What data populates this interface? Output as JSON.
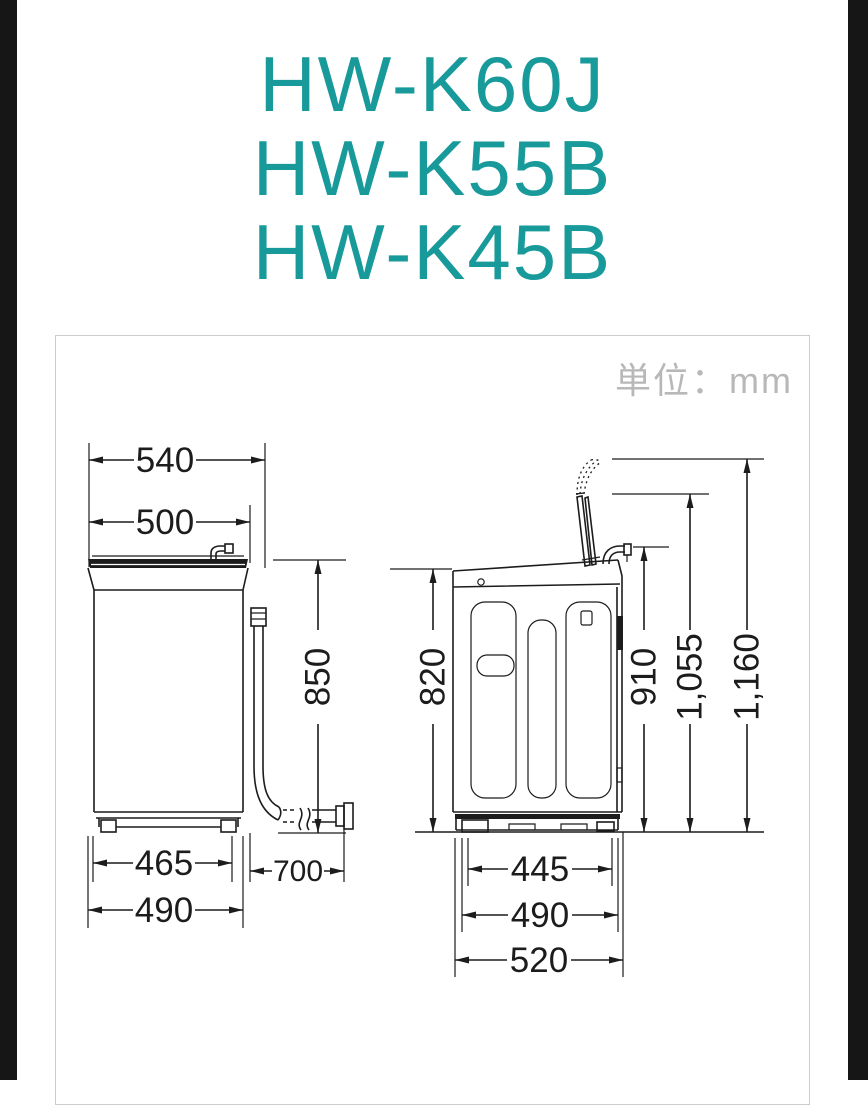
{
  "colors": {
    "accent_teal": "#189a9b",
    "drawing_line": "#1c1c1c",
    "unit_text_gray": "#b8b8b8",
    "bezel_black": "#161616",
    "panel_border": "#cccccc"
  },
  "title": {
    "models": [
      "HW-K60J",
      "HW-K55B",
      "HW-K45B"
    ]
  },
  "diagram": {
    "unit_label": "単位：mm",
    "front_view": {
      "dimensions": {
        "overall_width_mm": "540",
        "lid_width_mm": "500",
        "body_height_mm": "850",
        "feet_width_mm": "465",
        "base_width_mm": "490",
        "drain_hose_length_mm": "700"
      }
    },
    "side_view": {
      "dimensions": {
        "body_height_mm": "820",
        "hose_hook_height_mm": "910",
        "lid_open_height_mm": "1,055",
        "lid_open_max_height_mm": "1,160",
        "feet_depth_mm": "445",
        "base_depth_mm": "490",
        "overall_depth_mm": "520"
      }
    }
  }
}
